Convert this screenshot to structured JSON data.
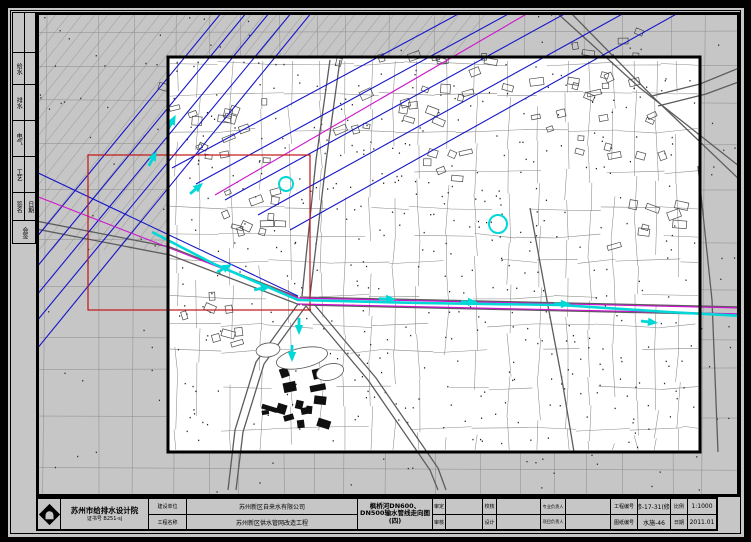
{
  "colors": {
    "paper": "#c6c6c6",
    "white": "#ffffff",
    "line": "#8a8a8a",
    "dark_line": "#5c5c5c",
    "blue": "#1515c8",
    "magenta": "#cc14cc",
    "cyan": "#00d8d8",
    "red": "#c01616",
    "black": "#000000"
  },
  "left_strip": {
    "rows": [
      {
        "l": "",
        "r": ""
      },
      {
        "l": "给水",
        "r": ""
      },
      {
        "l": "排水",
        "r": ""
      },
      {
        "l": "电气",
        "r": ""
      },
      {
        "l": "工艺",
        "r": ""
      }
    ],
    "sign": {
      "l": "签名",
      "r": "日期"
    },
    "bottom": "会签"
  },
  "title_block": {
    "institute": {
      "name": "苏州市给排水设计院",
      "cert": "证书号 B251-sj"
    },
    "fields": [
      {
        "label": "建设单位",
        "value": "苏州新区自来水有限公司"
      },
      {
        "label": "工程名称",
        "value": "苏州新区供水管网改造工程"
      }
    ],
    "drawing_title": "枫桥河DN600、DN500输水管线走向图(四)",
    "sign_fields": [
      {
        "top": "审定",
        "bottom": "审核"
      },
      {
        "top": "校核",
        "bottom": "设计"
      },
      {
        "top": "专业负责人",
        "bottom": "项目负责人"
      }
    ],
    "right_fields": [
      {
        "label": "工程编号",
        "value": "修-17-31(修)"
      },
      {
        "label": "图纸编号",
        "value": "水施-46"
      },
      {
        "label": "比例",
        "value": "1:1000"
      },
      {
        "label": "日期",
        "value": "2011.01"
      }
    ]
  },
  "map": {
    "seed": 7,
    "bold_rect": [
      168,
      57,
      532,
      395
    ],
    "red_rect": [
      88,
      155,
      222,
      155
    ],
    "blue_lines": [
      [
        [
          36,
          268
        ],
        [
          247,
          12
        ]
      ],
      [
        [
          36,
          296
        ],
        [
          270,
          12
        ]
      ],
      [
        [
          36,
          322
        ],
        [
          292,
          12
        ]
      ],
      [
        [
          36,
          350
        ],
        [
          312,
          12
        ]
      ],
      [
        [
          36,
          238
        ],
        [
          222,
          12
        ]
      ],
      [
        [
          36,
          172
        ],
        [
          298,
          296
        ]
      ],
      [
        [
          172,
          168
        ],
        [
          462,
          12
        ]
      ],
      [
        [
          196,
          184
        ],
        [
          512,
          12
        ]
      ],
      [
        [
          225,
          200
        ],
        [
          568,
          12
        ]
      ],
      [
        [
          258,
          215
        ],
        [
          626,
          12
        ]
      ],
      [
        [
          290,
          230
        ],
        [
          680,
          12
        ]
      ]
    ],
    "magenta_lines": [
      [
        [
          215,
          195
        ],
        [
          530,
          12
        ]
      ],
      [
        [
          36,
          196
        ],
        [
          298,
          298
        ]
      ]
    ],
    "magenta_double": [
      [
        [
          298,
          298
        ],
        [
          744,
          308
        ]
      ],
      [
        [
          298,
          304
        ],
        [
          744,
          314
        ]
      ]
    ],
    "cyan_path": [
      [
        152,
        232
      ],
      [
        214,
        264
      ],
      [
        298,
        300
      ],
      [
        420,
        303
      ],
      [
        560,
        305
      ],
      [
        668,
        312
      ],
      [
        744,
        316
      ]
    ],
    "cyan_arrows": [
      [
        172,
        122,
        -62
      ],
      [
        153,
        158,
        -62
      ],
      [
        197,
        188,
        -40
      ],
      [
        225,
        268,
        -28
      ],
      [
        263,
        288,
        -12
      ],
      [
        299,
        327,
        90
      ],
      [
        292,
        354,
        90
      ],
      [
        388,
        299,
        2
      ],
      [
        470,
        302,
        2
      ],
      [
        563,
        304,
        1
      ],
      [
        650,
        322,
        6
      ]
    ],
    "cyan_circles": [
      [
        286,
        184,
        7
      ],
      [
        498,
        224,
        9
      ]
    ],
    "roads": [
      [
        [
          556,
          12
        ],
        [
          640,
          88
        ],
        [
          744,
          170
        ]
      ],
      [
        [
          570,
          12
        ],
        [
          652,
          96
        ],
        [
          744,
          184
        ]
      ],
      [
        [
          652,
          96
        ],
        [
          700,
          84
        ],
        [
          744,
          66
        ]
      ],
      [
        [
          658,
          106
        ],
        [
          706,
          94
        ],
        [
          744,
          80
        ]
      ],
      [
        [
          36,
          221
        ],
        [
          170,
          247
        ],
        [
          298,
          297
        ]
      ],
      [
        [
          36,
          229
        ],
        [
          170,
          255
        ],
        [
          300,
          305
        ]
      ],
      [
        [
          300,
          297
        ],
        [
          744,
          307
        ]
      ],
      [
        [
          302,
          305
        ],
        [
          744,
          315
        ]
      ],
      [
        [
          330,
          60
        ],
        [
          316,
          160
        ],
        [
          302,
          296
        ]
      ],
      [
        [
          340,
          60
        ],
        [
          326,
          162
        ],
        [
          310,
          296
        ]
      ],
      [
        [
          298,
          304
        ],
        [
          256,
          362
        ],
        [
          235,
          430
        ],
        [
          228,
          490
        ]
      ],
      [
        [
          306,
          306
        ],
        [
          264,
          364
        ],
        [
          243,
          432
        ],
        [
          236,
          490
        ]
      ],
      [
        [
          306,
          306
        ],
        [
          368,
          380
        ],
        [
          430,
          470
        ],
        [
          438,
          490
        ]
      ],
      [
        [
          314,
          304
        ],
        [
          376,
          378
        ],
        [
          438,
          468
        ],
        [
          446,
          490
        ]
      ],
      [
        [
          530,
          208
        ],
        [
          548,
          306
        ],
        [
          562,
          380
        ],
        [
          574,
          452
        ]
      ],
      [
        [
          698,
          166
        ],
        [
          712,
          300
        ],
        [
          718,
          452
        ]
      ]
    ],
    "clusters": [
      [
        215,
        125,
        16,
        55
      ],
      [
        255,
        215,
        12,
        40
      ],
      [
        390,
        92,
        14,
        55
      ],
      [
        600,
        118,
        18,
        65
      ],
      [
        648,
        226,
        8,
        36
      ],
      [
        470,
        80,
        10,
        40
      ],
      [
        220,
        320,
        8,
        36
      ],
      [
        610,
        60,
        8,
        40
      ],
      [
        445,
        170,
        6,
        30
      ]
    ],
    "black_cluster": [
      296,
      396,
      14,
      38
    ],
    "ponds": [
      [
        302,
        358,
        26,
        10,
        -12
      ],
      [
        268,
        350,
        12,
        7,
        -8
      ],
      [
        330,
        372,
        14,
        8,
        -15
      ]
    ]
  }
}
